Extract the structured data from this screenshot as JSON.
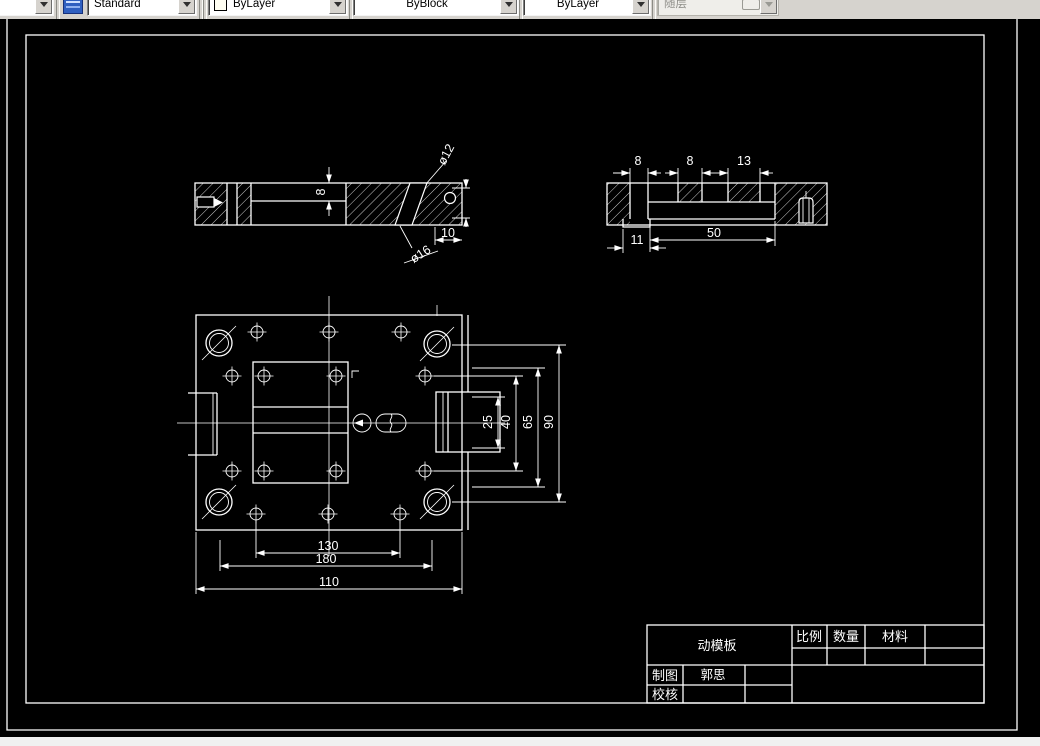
{
  "toolbar": {
    "style_combo": "Standard",
    "color_combo": "ByLayer",
    "lineweight_combo": "ByBlock",
    "linetype_combo": "ByLayer",
    "plot_style_combo": "随层"
  },
  "views": {
    "side_section": {
      "dim_thickness": "8",
      "dim_hole_small": "ø12",
      "dim_offset": "10",
      "dim_hole_large": "ø16"
    },
    "end_section": {
      "dim_slot_width": "8",
      "dim_step_width": "8",
      "dim_notch_width": "13",
      "dim_cavity_width": "50",
      "dim_tab_width": "11"
    },
    "plan": {
      "dim_core": "25",
      "dim_hole_rows": "40",
      "dim_cavity": "65",
      "dim_guide_vertical": "90",
      "dim_hole_span": "130",
      "dim_guide_span": "180",
      "dim_plate": "110"
    }
  },
  "title_block": {
    "part_name": "动模板",
    "scale_label": "比例",
    "quantity_label": "数量",
    "material_label": "材料",
    "drafter_label": "制图",
    "drafter_name": "郭思",
    "checker_label": "校核"
  },
  "colors": {
    "canvas_bg": "#000000",
    "line_color": "#ffffff",
    "toolbar_bg": "#d6d3ce",
    "icon_blue": "#2f5fc0"
  }
}
